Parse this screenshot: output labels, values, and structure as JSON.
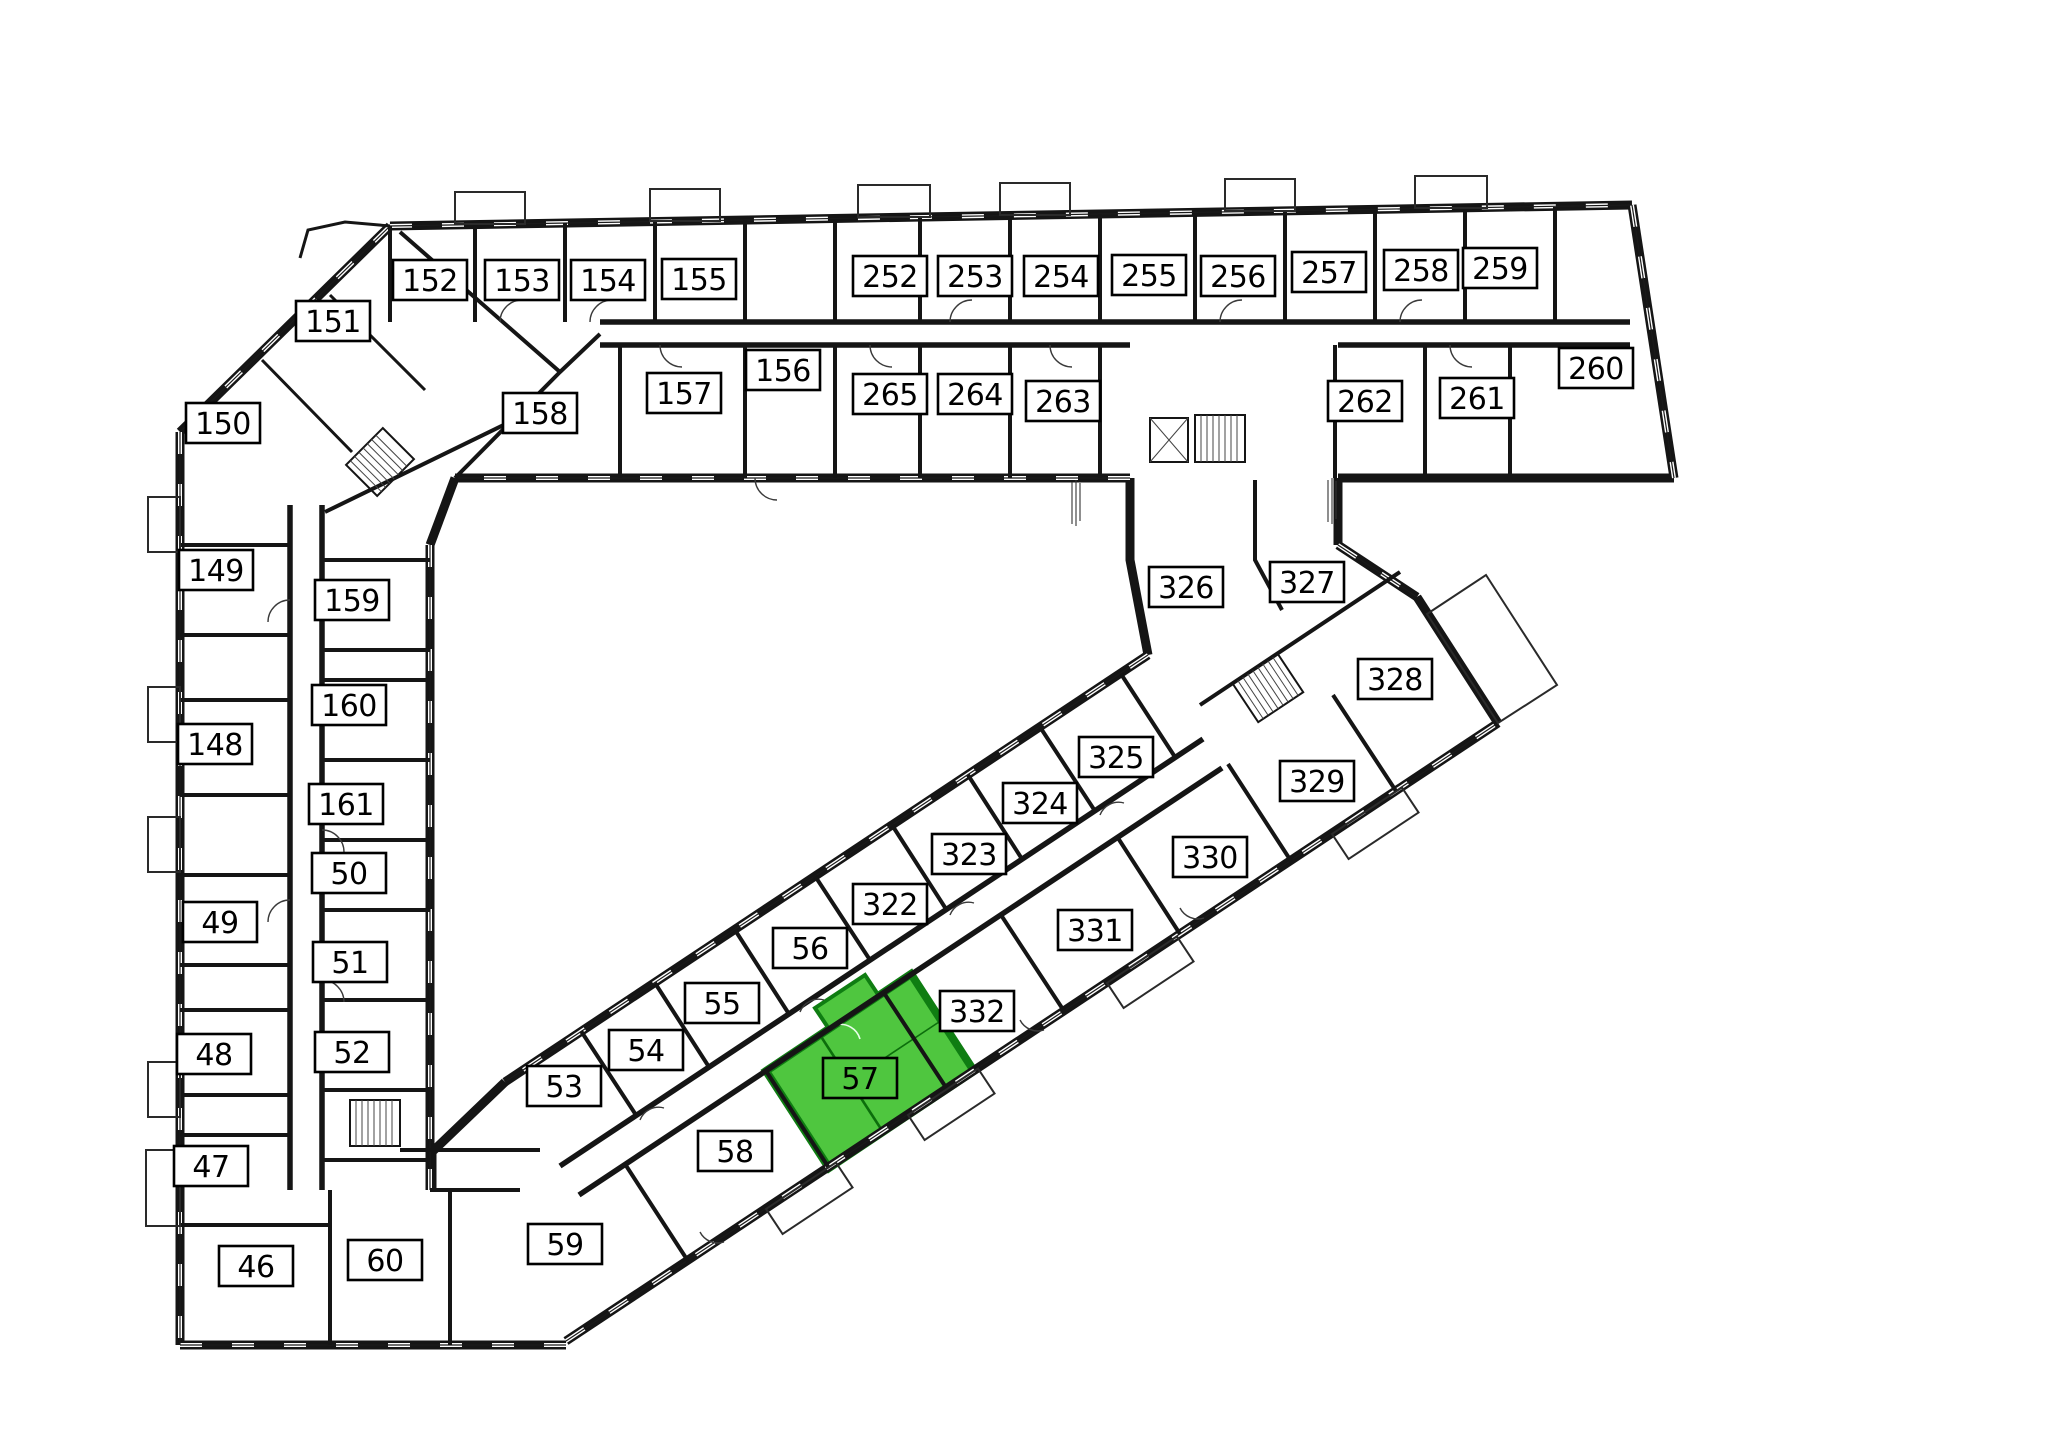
{
  "plan": {
    "background": "#ffffff",
    "wall_color": "#151515",
    "highlight": {
      "room": "57",
      "fill": "#4fc63f",
      "wall_color": "#0f7d12"
    },
    "label_style": {
      "fill": "#ffffff",
      "border": "#000000",
      "text": "#000000"
    },
    "rooms": [
      {
        "label": "152",
        "x": 430,
        "y": 280
      },
      {
        "label": "153",
        "x": 522,
        "y": 280
      },
      {
        "label": "154",
        "x": 608,
        "y": 280
      },
      {
        "label": "155",
        "x": 699,
        "y": 279
      },
      {
        "label": "252",
        "x": 890,
        "y": 276
      },
      {
        "label": "253",
        "x": 975,
        "y": 276
      },
      {
        "label": "254",
        "x": 1061,
        "y": 276
      },
      {
        "label": "255",
        "x": 1149,
        "y": 275
      },
      {
        "label": "256",
        "x": 1238,
        "y": 276
      },
      {
        "label": "257",
        "x": 1329,
        "y": 272
      },
      {
        "label": "258",
        "x": 1421,
        "y": 270
      },
      {
        "label": "259",
        "x": 1500,
        "y": 268
      },
      {
        "label": "151",
        "x": 333,
        "y": 321
      },
      {
        "label": "150",
        "x": 223,
        "y": 423
      },
      {
        "label": "158",
        "x": 540,
        "y": 413
      },
      {
        "label": "157",
        "x": 684,
        "y": 393
      },
      {
        "label": "156",
        "x": 783,
        "y": 370
      },
      {
        "label": "265",
        "x": 890,
        "y": 394
      },
      {
        "label": "264",
        "x": 975,
        "y": 394
      },
      {
        "label": "263",
        "x": 1063,
        "y": 401
      },
      {
        "label": "262",
        "x": 1365,
        "y": 401
      },
      {
        "label": "261",
        "x": 1477,
        "y": 398
      },
      {
        "label": "260",
        "x": 1596,
        "y": 368
      },
      {
        "label": "149",
        "x": 216,
        "y": 570
      },
      {
        "label": "159",
        "x": 352,
        "y": 600
      },
      {
        "label": "160",
        "x": 349,
        "y": 705
      },
      {
        "label": "161",
        "x": 346,
        "y": 804
      },
      {
        "label": "148",
        "x": 215,
        "y": 744
      },
      {
        "label": "50",
        "x": 349,
        "y": 873
      },
      {
        "label": "49",
        "x": 220,
        "y": 922
      },
      {
        "label": "51",
        "x": 350,
        "y": 962
      },
      {
        "label": "52",
        "x": 352,
        "y": 1052
      },
      {
        "label": "48",
        "x": 214,
        "y": 1054
      },
      {
        "label": "47",
        "x": 211,
        "y": 1166
      },
      {
        "label": "46",
        "x": 256,
        "y": 1266
      },
      {
        "label": "60",
        "x": 385,
        "y": 1260
      },
      {
        "label": "59",
        "x": 565,
        "y": 1244
      },
      {
        "label": "58",
        "x": 735,
        "y": 1151
      },
      {
        "label": "53",
        "x": 564,
        "y": 1086
      },
      {
        "label": "54",
        "x": 646,
        "y": 1050
      },
      {
        "label": "55",
        "x": 722,
        "y": 1003
      },
      {
        "label": "56",
        "x": 810,
        "y": 948
      },
      {
        "label": "57",
        "x": 860,
        "y": 1078,
        "highlighted": true
      },
      {
        "label": "322",
        "x": 890,
        "y": 904
      },
      {
        "label": "323",
        "x": 969,
        "y": 854
      },
      {
        "label": "324",
        "x": 1040,
        "y": 803
      },
      {
        "label": "325",
        "x": 1116,
        "y": 757
      },
      {
        "label": "326",
        "x": 1186,
        "y": 587
      },
      {
        "label": "327",
        "x": 1307,
        "y": 582
      },
      {
        "label": "328",
        "x": 1395,
        "y": 679
      },
      {
        "label": "329",
        "x": 1317,
        "y": 781
      },
      {
        "label": "330",
        "x": 1210,
        "y": 857
      },
      {
        "label": "331",
        "x": 1095,
        "y": 930
      },
      {
        "label": "332",
        "x": 977,
        "y": 1011
      }
    ]
  }
}
